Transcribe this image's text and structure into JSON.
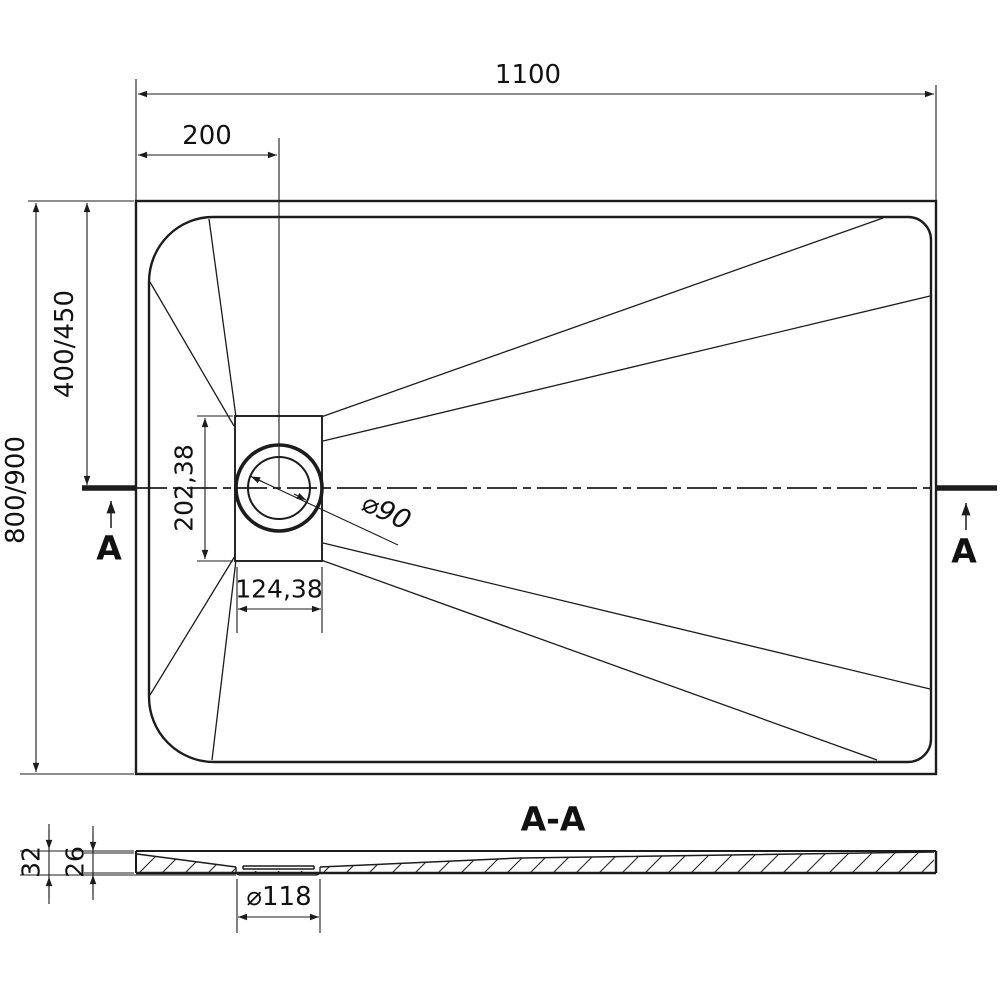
{
  "plan_view": {
    "dim_total_width": "1100",
    "dim_drain_offset": "200",
    "dim_total_depth": "800/900",
    "dim_drain_center_depth": "400/450",
    "dim_drain_box_depth": "202,38",
    "dim_drain_box_width": "124,38",
    "dim_drain_diameter": "⌀90",
    "section_marker_left": "A",
    "section_marker_right": "A"
  },
  "section_view": {
    "title": "A-A",
    "dim_overall_height": "32",
    "dim_tray_height": "26",
    "dim_flange_diameter": "⌀118"
  },
  "colors": {
    "line": "#1c1c1c",
    "background": "#ffffff"
  }
}
